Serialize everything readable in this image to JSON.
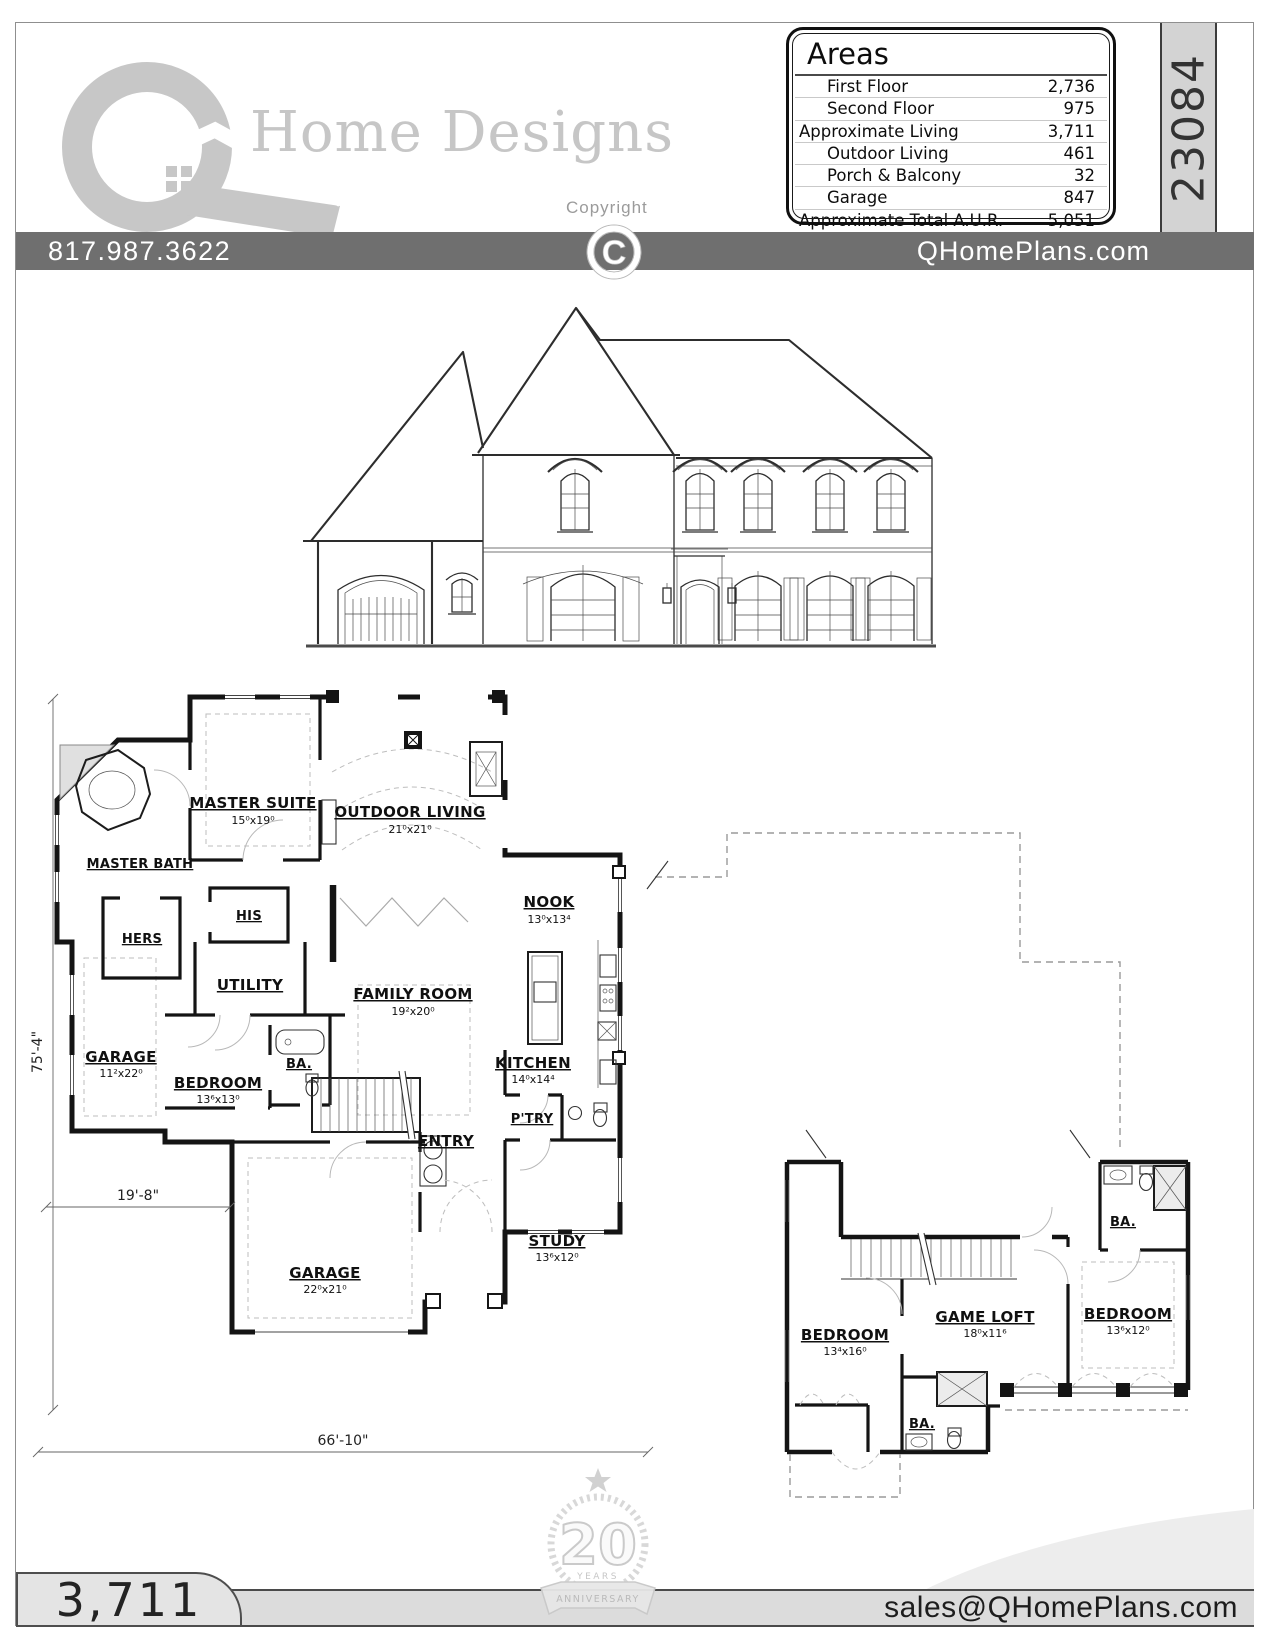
{
  "header": {
    "brand": "Home Designs",
    "copyright_label": "Copyright",
    "copyright_symbol": "C",
    "phone": "817.987.3622",
    "website": "QHomePlans.com",
    "plan_number": "23084",
    "areas": {
      "title": "Areas",
      "rows": [
        {
          "label": "First Floor",
          "value": "2,736"
        },
        {
          "label": "Second Floor",
          "value": "975"
        },
        {
          "label": "Approximate Living",
          "value": "3,711"
        },
        {
          "label": "Outdoor Living",
          "value": "461"
        },
        {
          "label": "Porch & Balcony",
          "value": "32"
        },
        {
          "label": "Garage",
          "value": "847"
        },
        {
          "label": "Approximate Total A.U.R.",
          "value": "5,051"
        }
      ]
    }
  },
  "plans": {
    "first_floor": {
      "rooms": [
        {
          "name": "MASTER SUITE",
          "dims": "15⁰x19⁰"
        },
        {
          "name": "OUTDOOR LIVING",
          "dims": "21⁰x21⁰"
        },
        {
          "name": "MASTER BATH"
        },
        {
          "name": "NOOK",
          "dims": "13⁰x13⁴"
        },
        {
          "name": "HERS"
        },
        {
          "name": "HIS"
        },
        {
          "name": "UTILITY"
        },
        {
          "name": "FAMILY ROOM",
          "dims": "19²x20⁰"
        },
        {
          "name": "KITCHEN",
          "dims": "14⁰x14⁴"
        },
        {
          "name": "GARAGE",
          "dims": "11²x22⁰"
        },
        {
          "name": "BEDROOM",
          "dims": "13⁶x13⁰"
        },
        {
          "name": "BA."
        },
        {
          "name": "P'TRY"
        },
        {
          "name": "ENTRY"
        },
        {
          "name": "STUDY",
          "dims": "13⁶x12⁰"
        },
        {
          "name": "GARAGE",
          "dims": "22⁰x21⁰"
        }
      ],
      "dimensions": {
        "left": "75'-4\"",
        "bottom": "66'-10\"",
        "garage_width": "19'-8\""
      }
    },
    "second_floor": {
      "rooms": [
        {
          "name": "BEDROOM",
          "dims": "13⁴x16⁰"
        },
        {
          "name": "GAME LOFT",
          "dims": "18⁰x11⁶"
        },
        {
          "name": "BEDROOM",
          "dims": "13⁶x12⁰"
        },
        {
          "name": "BA."
        },
        {
          "name": "BA."
        }
      ]
    }
  },
  "footer": {
    "living_area": "3,711",
    "email": "sales@QHomePlans.com",
    "anniversary": {
      "number": "20",
      "years_label": "YEARS",
      "banner": "ANNIVERSARY"
    }
  }
}
